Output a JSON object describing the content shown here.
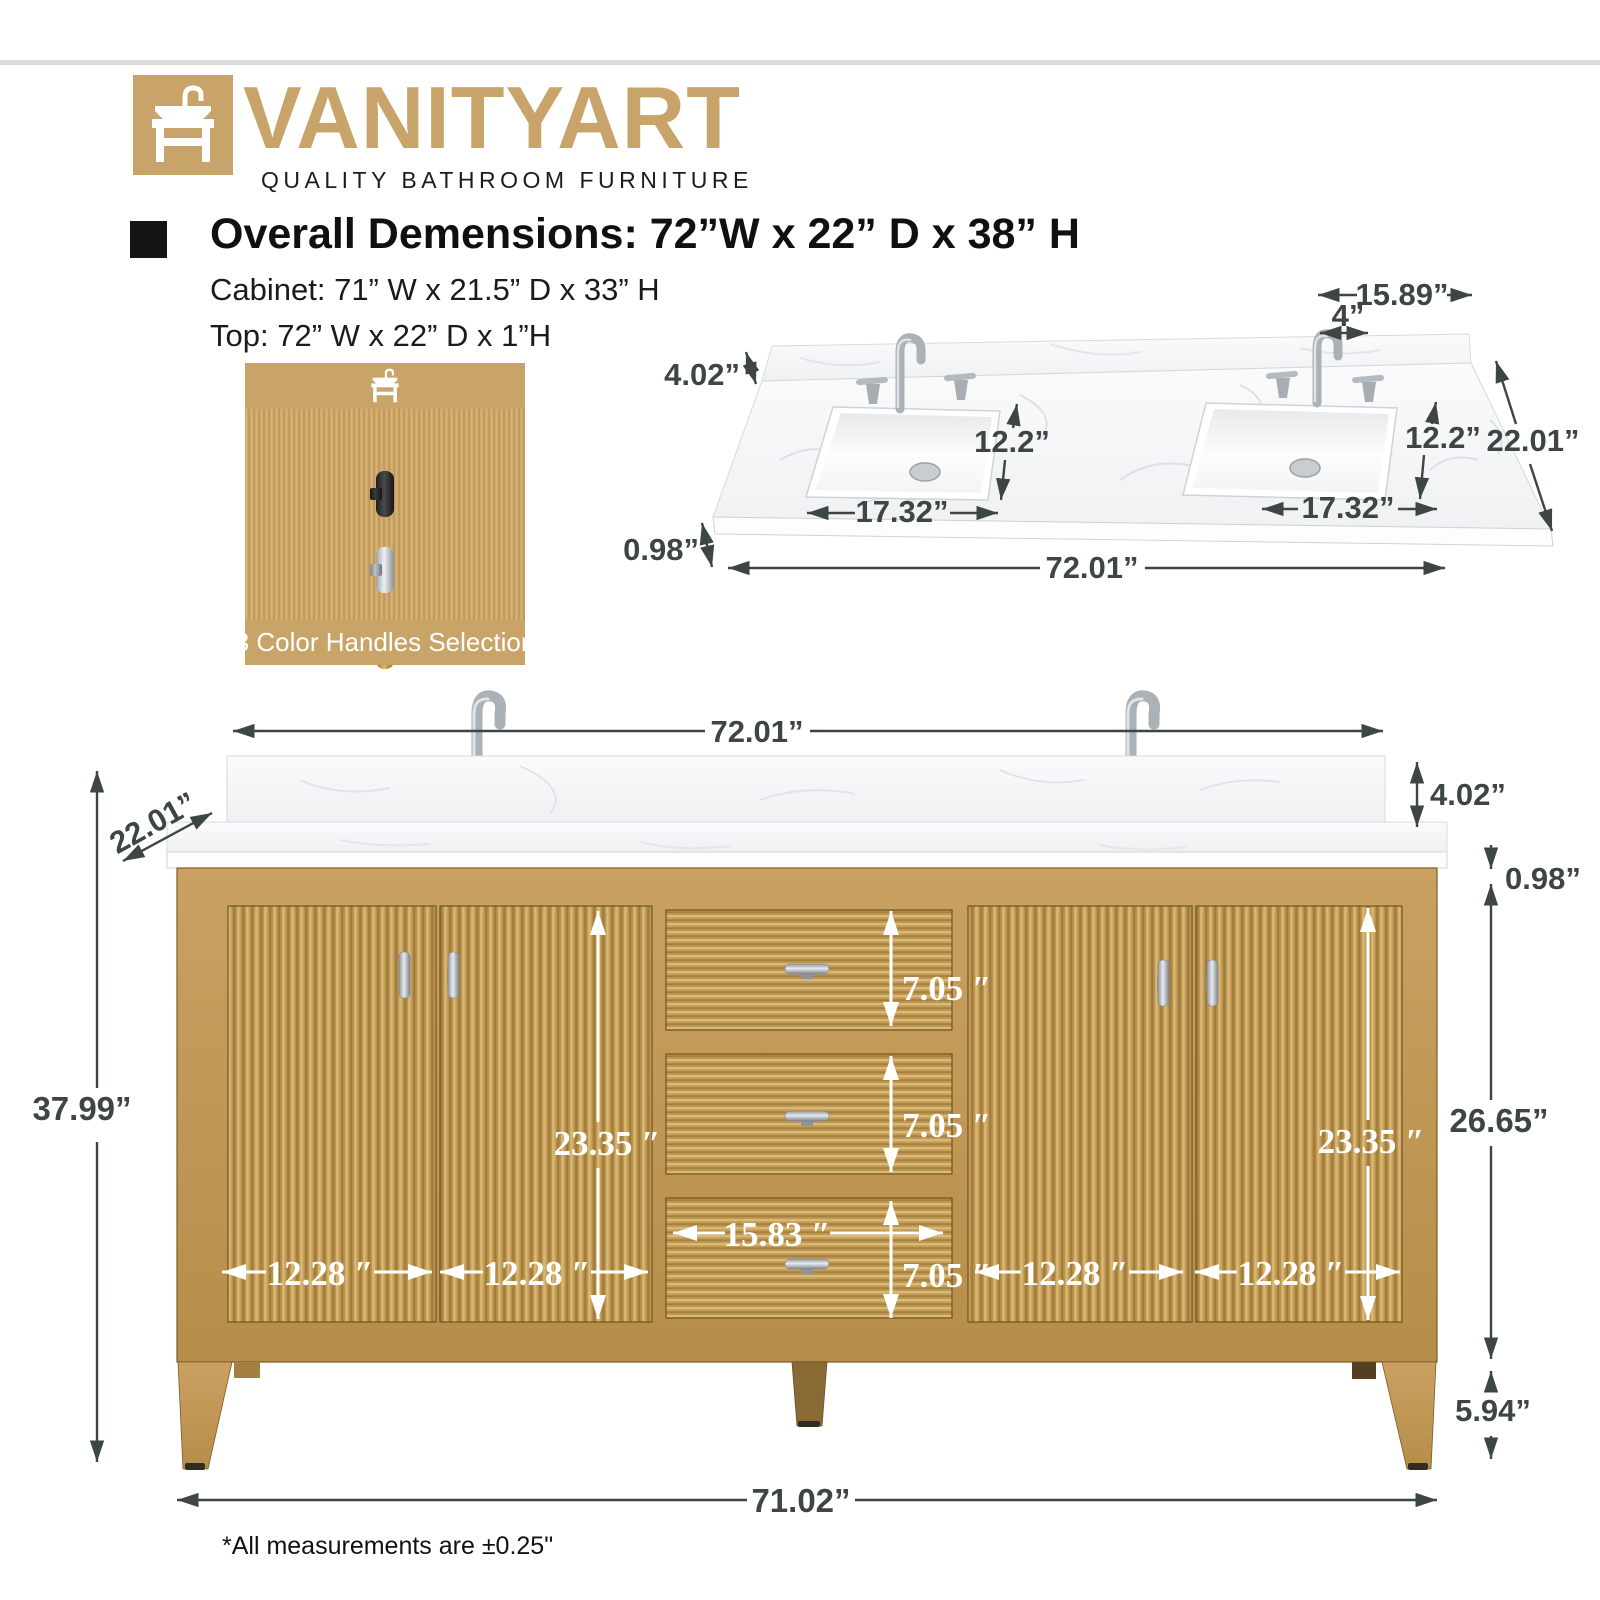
{
  "brand": {
    "name": "VANITYART",
    "tagline": "QUALITY BATHROOM FURNITURE",
    "accent_color": "#c9a46a"
  },
  "specs": {
    "overall": "Overall Demensions: 72”W x 22” D x 38” H",
    "cabinet": "Cabinet: 71” W x 21.5” D x 33” H",
    "top": "Top: 72” W x 22” D x 1”H"
  },
  "handles": {
    "caption": "3 Color Handles Selection",
    "colors": [
      "black",
      "chrome",
      "gold"
    ]
  },
  "countertop_view": {
    "back_width": "15.89”",
    "faucet_spread": "4”",
    "backsplash_height": "4.02”",
    "sink_depth_left": "12.2”",
    "sink_depth_right": "12.2”",
    "depth": "22.01”",
    "sink_width_left": "17.32”",
    "sink_width_right": "17.32”",
    "thickness": "0.98”",
    "width": "72.01”"
  },
  "front_view": {
    "top_width": "72.01”",
    "depth": "22.01”",
    "backsplash_height": "4.02”",
    "counter_thickness": "0.98”",
    "overall_height": "37.99”",
    "door_height_left": "23.35 ″",
    "door_height_right": "23.35 ″",
    "drawer_height_1": "7.05 ″",
    "drawer_height_2": "7.05 ″",
    "drawer_height_3": "7.05 ″",
    "drawer_width": "15.83 ″",
    "door_width_1": "12.28 ″",
    "door_width_2": "12.28 ″",
    "door_width_3": "12.28 ″",
    "door_width_4": "12.28 ″",
    "cabinet_height": "26.65”",
    "leg_height": "5.94”",
    "base_width": "71.02”"
  },
  "note": "*All measurements are ±0.25\"",
  "colors": {
    "dimension_text": "#3d4545",
    "wood_light": "#d8b873",
    "wood_dark": "#a8813f",
    "marble": "#f6f7f8"
  }
}
